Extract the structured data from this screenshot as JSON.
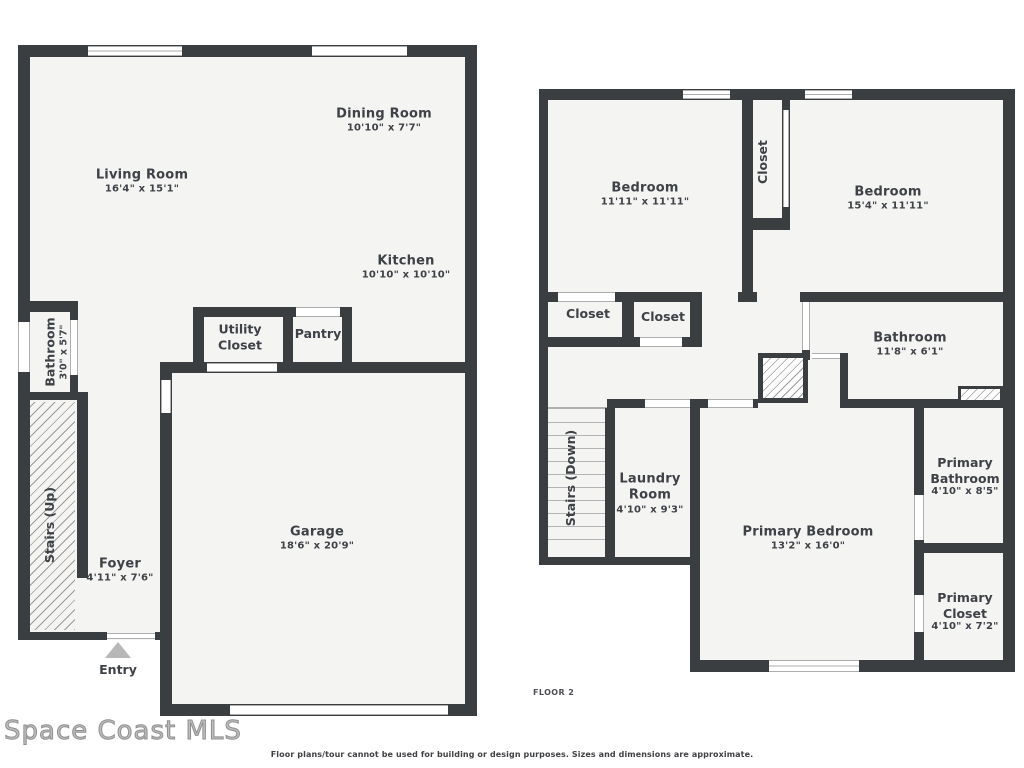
{
  "colors": {
    "wall": "#3b3e40",
    "floor": "#f4f4f3",
    "line": "#aeaeae",
    "label": "#3e4146",
    "entry": "#b7b7b7"
  },
  "floor1": {
    "living": {
      "name": "Living Room",
      "dims": "16'4\" x 15'1\""
    },
    "dining": {
      "name": "Dining Room",
      "dims": "10'10\" x 7'7\""
    },
    "kitchen": {
      "name": "Kitchen",
      "dims": "10'10\" x 10'10\""
    },
    "bathroom": {
      "name": "Bathroom",
      "dims": "3'0\" x 5'7\""
    },
    "utility": {
      "line1": "Utility",
      "line2": "Closet"
    },
    "pantry": {
      "name": "Pantry"
    },
    "garage": {
      "name": "Garage",
      "dims": "18'6\" x 20'9\""
    },
    "foyer": {
      "name": "Foyer",
      "dims": "4'11\" x 7'6\""
    },
    "stairs": {
      "name": "Stairs (Up)"
    },
    "entry": {
      "name": "Entry"
    }
  },
  "floor2": {
    "bedroom_left": {
      "name": "Bedroom",
      "dims": "11'11\" x 11'11\""
    },
    "bedroom_right": {
      "name": "Bedroom",
      "dims": "15'4\" x 11'11\""
    },
    "closet_top": {
      "name": "Closet"
    },
    "closet_left": {
      "name": "Closet"
    },
    "closet_mid": {
      "name": "Closet"
    },
    "bathroom": {
      "name": "Bathroom",
      "dims": "11'8\" x 6'1\""
    },
    "stairs": {
      "name": "Stairs (Down)"
    },
    "laundry": {
      "line1": "Laundry",
      "line2": "Room",
      "dims": "4'10\" x 9'3\""
    },
    "primary_bedroom": {
      "name": "Primary Bedroom",
      "dims": "13'2\" x 16'0\""
    },
    "primary_bathroom": {
      "line1": "Primary",
      "line2": "Bathroom",
      "dims": "4'10\" x 8'5\""
    },
    "primary_closet": {
      "line1": "Primary",
      "line2": "Closet",
      "dims": "4'10\" x 7'2\""
    }
  },
  "footer": {
    "floor_caption": "FLOOR 2",
    "disclaimer": "Floor plans/tour cannot be used for building or design purposes. Sizes and dimensions are approximate.",
    "watermark": "Space Coast MLS"
  }
}
